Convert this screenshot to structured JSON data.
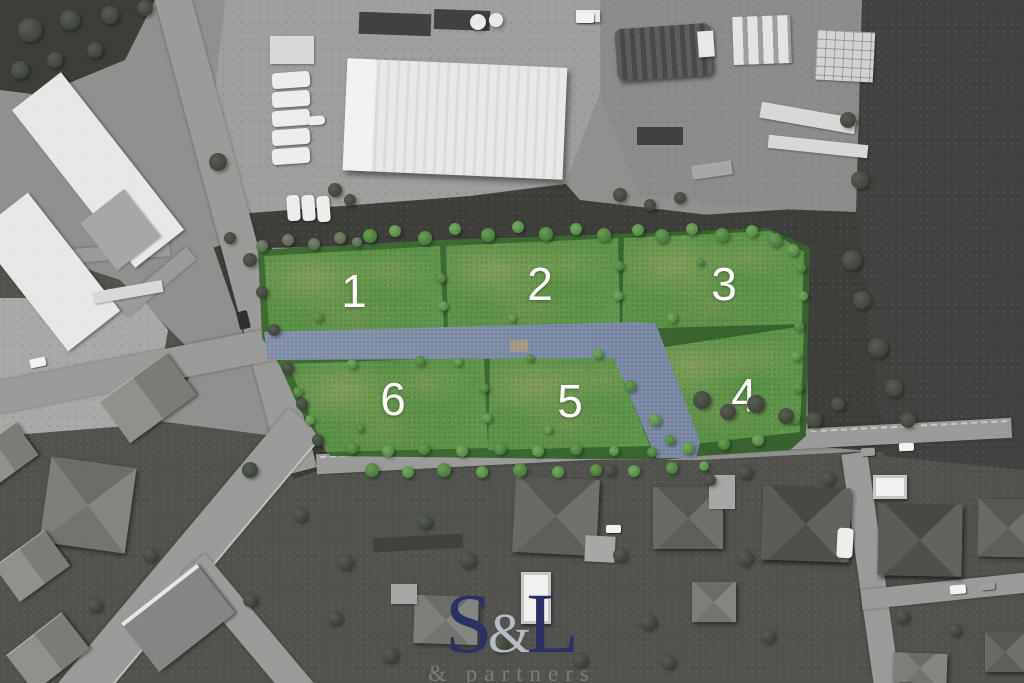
{
  "plots": [
    {
      "id": "plot-1",
      "label": "1"
    },
    {
      "id": "plot-2",
      "label": "2"
    },
    {
      "id": "plot-3",
      "label": "3"
    },
    {
      "id": "plot-4",
      "label": "4"
    },
    {
      "id": "plot-5",
      "label": "5"
    },
    {
      "id": "plot-6",
      "label": "6"
    }
  ],
  "watermark": {
    "letter_s": "S",
    "ampersand": "&",
    "letter_l": "L",
    "subtitle": "& partners"
  },
  "colors": {
    "plot_green": "#5f9349",
    "plot_green_dark": "#549042",
    "hedge_green": "#3e6b33",
    "road_blue": "#7e8ca6",
    "road_blue_dark": "#73829d",
    "logo_navy": "#2b3263",
    "logo_silver": "#b7bbc5"
  }
}
